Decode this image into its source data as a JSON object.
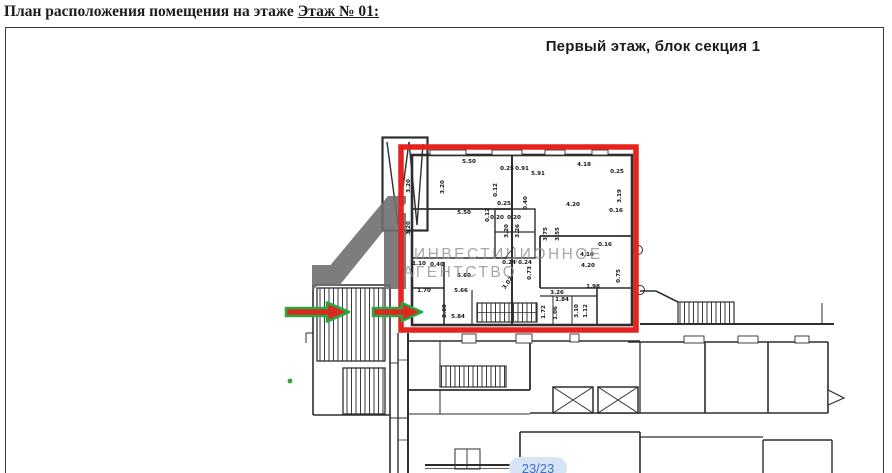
{
  "page": {
    "heading_prefix": "План расположения помещения на этаже",
    "heading_floor": "Этаж № 01:",
    "plan_title": "Первый этаж, блок секция 1",
    "page_indicator": "23/23"
  },
  "watermark": {
    "line1": "ИНВЕСТИЦИОННОЕ",
    "line2": "АГЕНТСТВО",
    "logo": "investment-agency-logo"
  },
  "annotations": {
    "highlight_box": "selected-premises-outline",
    "arrows": [
      "entrance-arrow-left",
      "entrance-arrow-right"
    ]
  },
  "colors": {
    "highlight_red": "#e52420",
    "arrow_green": "#28a843",
    "arrow_fill_red": "#da2a20",
    "watermark_gray": "#8f8f8f",
    "logo_gray": "#6f6f6f",
    "badge_bg": "#d7e4f5",
    "badge_text": "#3b6fc9",
    "plan_line": "#2e2e2e"
  },
  "plan": {
    "dimensions": [
      {
        "t": "5.50",
        "x": 469,
        "y": 163,
        "r": 0
      },
      {
        "t": "0.25",
        "x": 507,
        "y": 170,
        "r": 0
      },
      {
        "t": "0.91",
        "x": 522,
        "y": 170,
        "r": 0
      },
      {
        "t": "5.91",
        "x": 538,
        "y": 175,
        "r": 0
      },
      {
        "t": "4.18",
        "x": 584,
        "y": 166,
        "r": 0
      },
      {
        "t": "0.25",
        "x": 617,
        "y": 173,
        "r": 0
      },
      {
        "t": "3.20",
        "x": 410,
        "y": 186,
        "r": -90
      },
      {
        "t": "3.20",
        "x": 444,
        "y": 187,
        "r": -90
      },
      {
        "t": "0.12",
        "x": 497,
        "y": 190,
        "r": -90
      },
      {
        "t": "3.19",
        "x": 621,
        "y": 196,
        "r": -90
      },
      {
        "t": "0.25",
        "x": 504,
        "y": 205,
        "r": 0
      },
      {
        "t": "0.40",
        "x": 527,
        "y": 203,
        "r": -90
      },
      {
        "t": "5.50",
        "x": 464,
        "y": 214,
        "r": 0
      },
      {
        "t": "4.20",
        "x": 573,
        "y": 206,
        "r": 0
      },
      {
        "t": "0.16",
        "x": 616,
        "y": 212,
        "r": 0
      },
      {
        "t": "0.20",
        "x": 497,
        "y": 219,
        "r": 0
      },
      {
        "t": "0.20",
        "x": 514,
        "y": 219,
        "r": 0
      },
      {
        "t": "0.12",
        "x": 489,
        "y": 215,
        "r": -90
      },
      {
        "t": "3.20",
        "x": 508,
        "y": 231,
        "r": -90
      },
      {
        "t": "3.26",
        "x": 519,
        "y": 231,
        "r": -90
      },
      {
        "t": "3.75",
        "x": 547,
        "y": 234,
        "r": -90
      },
      {
        "t": "3.55",
        "x": 559,
        "y": 234,
        "r": -90
      },
      {
        "t": "3.20",
        "x": 410,
        "y": 228,
        "r": -90
      },
      {
        "t": "1.10",
        "x": 419,
        "y": 265,
        "r": 0
      },
      {
        "t": "0.40",
        "x": 437,
        "y": 266,
        "r": 0
      },
      {
        "t": "0.16",
        "x": 605,
        "y": 246,
        "r": 0
      },
      {
        "t": "4.10",
        "x": 587,
        "y": 256,
        "r": 0
      },
      {
        "t": "4.20",
        "x": 588,
        "y": 267,
        "r": 0
      },
      {
        "t": "0.24",
        "x": 509,
        "y": 264,
        "r": 0
      },
      {
        "t": "0.24",
        "x": 525,
        "y": 264,
        "r": 0
      },
      {
        "t": "0.73",
        "x": 531,
        "y": 273,
        "r": -90
      },
      {
        "t": "5.60",
        "x": 464,
        "y": 277,
        "r": 0
      },
      {
        "t": "3.02",
        "x": 509,
        "y": 284,
        "r": -55
      },
      {
        "t": "0.75",
        "x": 620,
        "y": 276,
        "r": -90
      },
      {
        "t": "1.70",
        "x": 424,
        "y": 292,
        "r": 0
      },
      {
        "t": "5.66",
        "x": 461,
        "y": 292,
        "r": 0
      },
      {
        "t": "1.98",
        "x": 593,
        "y": 288,
        "r": 0
      },
      {
        "t": "3.26",
        "x": 557,
        "y": 294,
        "r": 0
      },
      {
        "t": "1.84",
        "x": 562,
        "y": 301,
        "r": 0
      },
      {
        "t": "2.60",
        "x": 446,
        "y": 311,
        "r": -90
      },
      {
        "t": "1.72",
        "x": 545,
        "y": 312,
        "r": -90
      },
      {
        "t": "1.06",
        "x": 557,
        "y": 313,
        "r": -90
      },
      {
        "t": "3.10",
        "x": 578,
        "y": 311,
        "r": -90
      },
      {
        "t": "1.12",
        "x": 587,
        "y": 311,
        "r": -90
      },
      {
        "t": "5.84",
        "x": 458,
        "y": 318,
        "r": 0
      }
    ]
  }
}
